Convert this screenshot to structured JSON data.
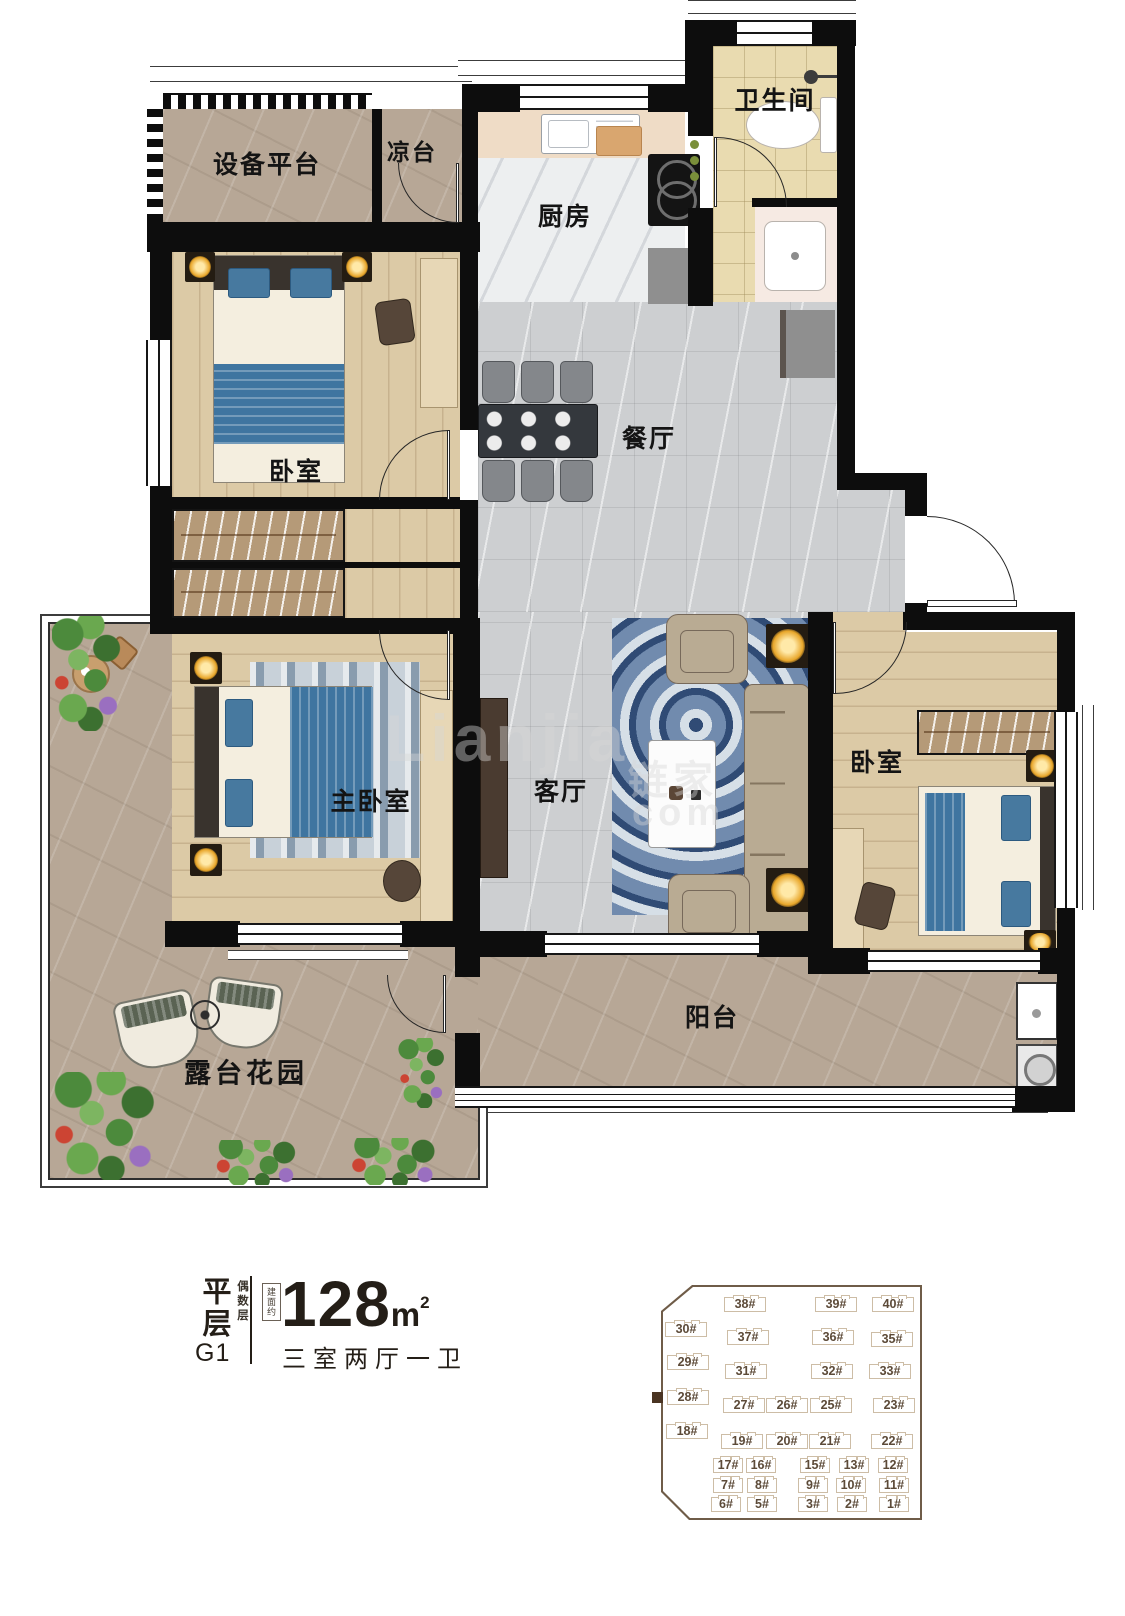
{
  "colors": {
    "wall": "#0d0d0d",
    "floor_stone_warm": "#b7a796",
    "floor_stone_gray": "#cdcfd1",
    "floor_wood": "#dccaa6",
    "floor_kitchen": "#edeff0",
    "floor_tile": "#e9dbb0",
    "accent_blue": "#3f75a0",
    "rug_blue": "#2b4f7e",
    "sofa_tan": "#b9ab93",
    "lamp_glow": "#e8a62a",
    "sitemap_outline": "#6f5c48",
    "sitemap_building_line": "#cdbda6",
    "sitemap_text": "#5c4a38",
    "sitemap_highlight": "#4a3422",
    "info_text": "#241e17"
  },
  "floor_plan": {
    "rooms": {
      "equipment_platform": {
        "label": "设备平台"
      },
      "cool_terrace": {
        "label": "凉台"
      },
      "kitchen": {
        "label": "厨房"
      },
      "bathroom": {
        "label": "卫生间"
      },
      "bedroom_top": {
        "label": "卧室"
      },
      "dining": {
        "label": "餐厅"
      },
      "master_bedroom": {
        "label": "主卧室"
      },
      "living_room": {
        "label": "客厅"
      },
      "bedroom_right": {
        "label": "卧室"
      },
      "balcony": {
        "label": "阳台"
      },
      "terrace_garden": {
        "label": "露台花园"
      }
    },
    "watermark": {
      "latin": "Lianjia",
      "cjk": "链家",
      "suffix": "com"
    }
  },
  "info_panel": {
    "type_vertical": "平层",
    "unit_code": "G1",
    "floor_parity_vertical": "偶数层",
    "area_prefix_vertical": "建面约",
    "area_value": "128",
    "area_unit": "m",
    "area_exponent": "2",
    "layout_text": "三室两厅一卫"
  },
  "site_map": {
    "highlight_label": "28#",
    "buildings": [
      {
        "label": "38#",
        "cx": 82,
        "cy": 17
      },
      {
        "label": "39#",
        "cx": 173,
        "cy": 17
      },
      {
        "label": "40#",
        "cx": 230,
        "cy": 17
      },
      {
        "label": "30#",
        "cx": 23,
        "cy": 42
      },
      {
        "label": "37#",
        "cx": 85,
        "cy": 50
      },
      {
        "label": "36#",
        "cx": 170,
        "cy": 50
      },
      {
        "label": "35#",
        "cx": 229,
        "cy": 52
      },
      {
        "label": "29#",
        "cx": 25,
        "cy": 75
      },
      {
        "label": "31#",
        "cx": 83,
        "cy": 84
      },
      {
        "label": "32#",
        "cx": 169,
        "cy": 84
      },
      {
        "label": "33#",
        "cx": 227,
        "cy": 84
      },
      {
        "label": "28#",
        "cx": 25,
        "cy": 110
      },
      {
        "label": "27#",
        "cx": 81,
        "cy": 118
      },
      {
        "label": "26#",
        "cx": 124,
        "cy": 118
      },
      {
        "label": "25#",
        "cx": 168,
        "cy": 118
      },
      {
        "label": "23#",
        "cx": 231,
        "cy": 118
      },
      {
        "label": "18#",
        "cx": 24,
        "cy": 144
      },
      {
        "label": "19#",
        "cx": 79,
        "cy": 154
      },
      {
        "label": "20#",
        "cx": 124,
        "cy": 154
      },
      {
        "label": "21#",
        "cx": 167,
        "cy": 154
      },
      {
        "label": "22#",
        "cx": 229,
        "cy": 154
      },
      {
        "label": "17#",
        "cx": 65,
        "cy": 178
      },
      {
        "label": "16#",
        "cx": 98,
        "cy": 178
      },
      {
        "label": "15#",
        "cx": 152,
        "cy": 178
      },
      {
        "label": "13#",
        "cx": 191,
        "cy": 178
      },
      {
        "label": "12#",
        "cx": 230,
        "cy": 178
      },
      {
        "label": "7#",
        "cx": 65,
        "cy": 198
      },
      {
        "label": "8#",
        "cx": 99,
        "cy": 198
      },
      {
        "label": "9#",
        "cx": 150,
        "cy": 198
      },
      {
        "label": "10#",
        "cx": 188,
        "cy": 198
      },
      {
        "label": "11#",
        "cx": 231,
        "cy": 198
      },
      {
        "label": "6#",
        "cx": 63,
        "cy": 217
      },
      {
        "label": "5#",
        "cx": 99,
        "cy": 217
      },
      {
        "label": "3#",
        "cx": 150,
        "cy": 217
      },
      {
        "label": "2#",
        "cx": 189,
        "cy": 217
      },
      {
        "label": "1#",
        "cx": 231,
        "cy": 217
      }
    ]
  }
}
